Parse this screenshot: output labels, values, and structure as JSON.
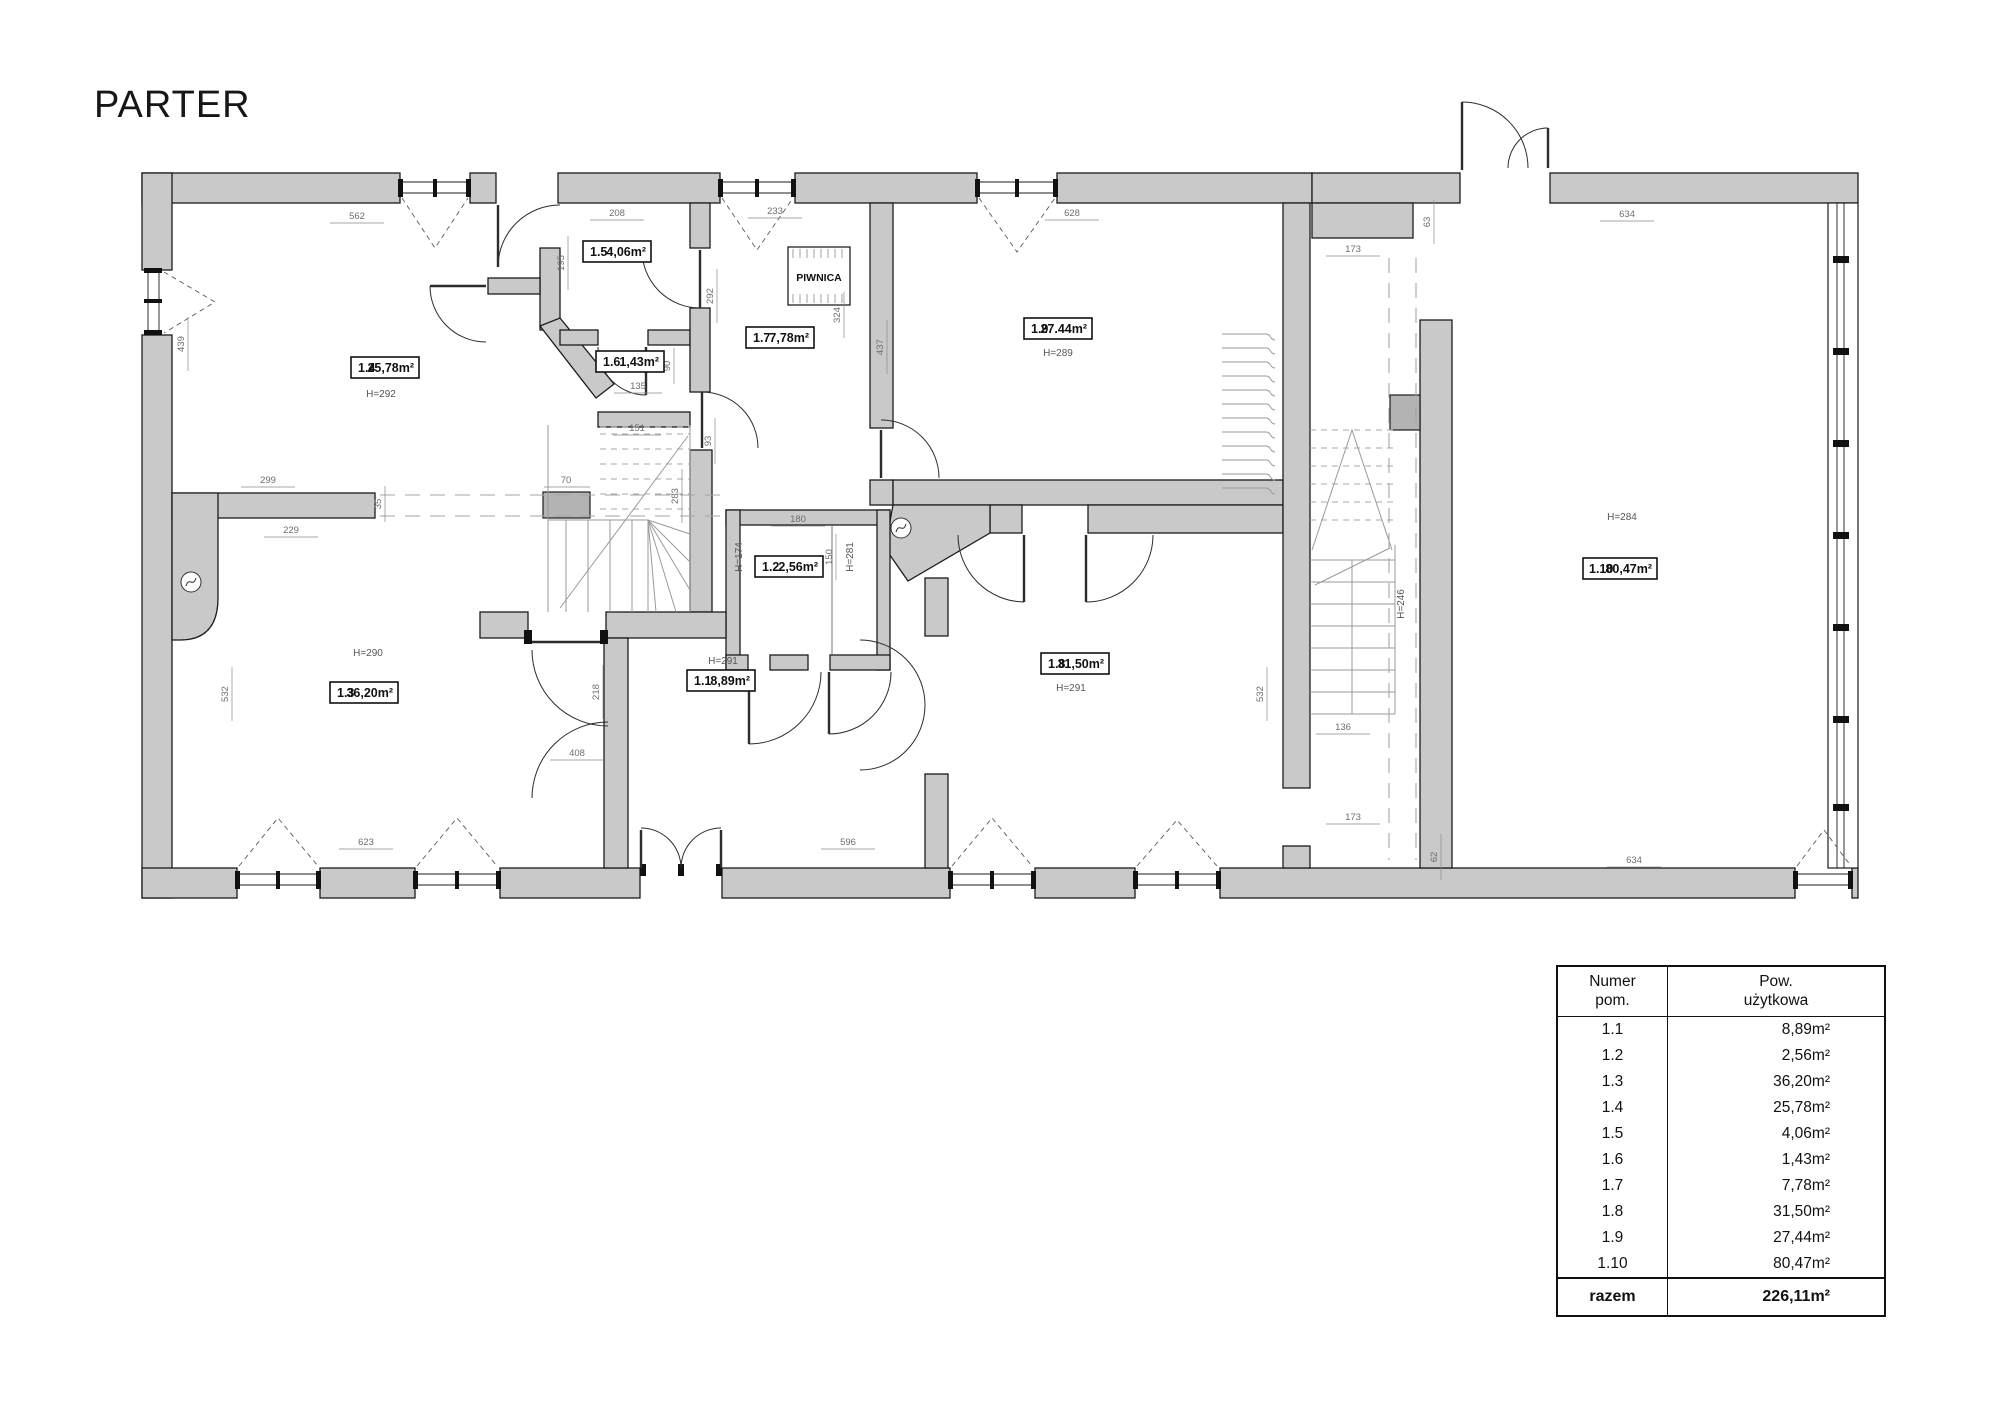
{
  "title": "PARTER",
  "colors": {
    "wall": "#c9c9c9",
    "line": "#1b1b1b",
    "dim_text": "#6e6e6e",
    "stair": "#9a9a9a"
  },
  "plan": {
    "basement_label": "PIWNICA",
    "rooms": [
      {
        "id": "1.1",
        "area": "8,89m²",
        "h": "H=291"
      },
      {
        "id": "1.2",
        "area": "2,56m²",
        "h": ""
      },
      {
        "id": "1.3",
        "area": "36,20m²",
        "h": "H=290"
      },
      {
        "id": "1.4",
        "area": "25,78m²",
        "h": "H=292"
      },
      {
        "id": "1.5",
        "area": "4,06m²",
        "h": ""
      },
      {
        "id": "1.6",
        "area": "1,43m²",
        "h": ""
      },
      {
        "id": "1.7",
        "area": "7,78m²",
        "h": ""
      },
      {
        "id": "1.8",
        "area": "31,50m²",
        "h": "H=291"
      },
      {
        "id": "1.9",
        "area": "27.44m²",
        "h": "H=289"
      },
      {
        "id": "1.10",
        "area": "80,47m²",
        "h": "H=284"
      }
    ],
    "extra_heights": [
      "H=174",
      "H=281",
      "H=246"
    ],
    "dims": [
      "562",
      "439",
      "208",
      "195",
      "233",
      "628",
      "173",
      "63",
      "634",
      "292",
      "324",
      "437",
      "90",
      "135",
      "151",
      "283",
      "93",
      "70",
      "299",
      "35",
      "229",
      "532",
      "623",
      "408",
      "218",
      "596",
      "180",
      "150",
      "136",
      "532",
      "173",
      "62",
      "634"
    ]
  },
  "table": {
    "header": {
      "col1_line1": "Numer",
      "col1_line2": "pom.",
      "col2_line1": "Pow.",
      "col2_line2": "użytkowa"
    },
    "rows": [
      {
        "num": "1.1",
        "area": "8,89m²"
      },
      {
        "num": "1.2",
        "area": "2,56m²"
      },
      {
        "num": "1.3",
        "area": "36,20m²"
      },
      {
        "num": "1.4",
        "area": "25,78m²"
      },
      {
        "num": "1.5",
        "area": "4,06m²"
      },
      {
        "num": "1.6",
        "area": "1,43m²"
      },
      {
        "num": "1.7",
        "area": "7,78m²"
      },
      {
        "num": "1.8",
        "area": "31,50m²"
      },
      {
        "num": "1.9",
        "area": "27,44m²"
      },
      {
        "num": "1.10",
        "area": "80,47m²"
      }
    ],
    "total_label": "razem",
    "total_area": "226,11m²"
  }
}
